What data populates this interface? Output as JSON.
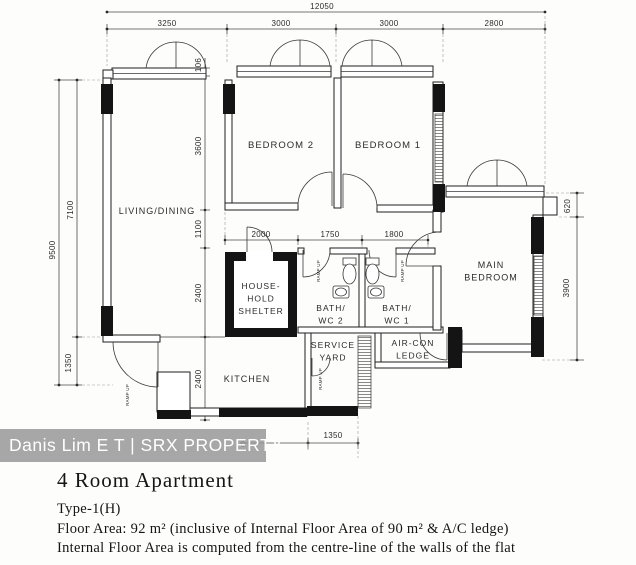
{
  "watermark": {
    "text": "Danis Lim E T | SRX PROPERTY",
    "bar_color": "rgba(152,152,152,0.85)",
    "text_color": "#ffffff"
  },
  "caption": {
    "title": "4 Room Apartment",
    "type": "Type-1(H)",
    "floor_area": "Floor Area: 92 m² (inclusive of Internal Floor Area of 90 m² & A/C ledge)",
    "note": "Internal Floor Area is computed from the centre-line of the walls of the flat"
  },
  "colors": {
    "plan_line": "#1f1f1f",
    "dimension_text": "#333333",
    "background": "#fdfdfb"
  },
  "rooms": [
    {
      "name": "living-dining",
      "lines": [
        "LIVING/DINING"
      ],
      "x": 157,
      "y": 214,
      "fs": 9
    },
    {
      "name": "bedroom-2",
      "lines": [
        "BEDROOM 2"
      ],
      "x": 281,
      "y": 148,
      "fs": 9.5
    },
    {
      "name": "bedroom-1",
      "lines": [
        "BEDROOM 1"
      ],
      "x": 388,
      "y": 148,
      "fs": 9.5
    },
    {
      "name": "main-bedroom",
      "lines": [
        "MAIN",
        "BEDROOM"
      ],
      "x": 491,
      "y": 268,
      "fs": 9
    },
    {
      "name": "household-shelter",
      "lines": [
        "HOUSE-",
        "HOLD",
        "SHELTER"
      ],
      "x": 261,
      "y": 289,
      "fs": 8.5
    },
    {
      "name": "bath-wc-2",
      "lines": [
        "BATH/",
        "WC 2"
      ],
      "x": 331,
      "y": 311,
      "fs": 8.5
    },
    {
      "name": "bath-wc-1",
      "lines": [
        "BATH/",
        "WC 1"
      ],
      "x": 397,
      "y": 311,
      "fs": 8.5
    },
    {
      "name": "service-yard",
      "lines": [
        "SERVICE",
        "YARD"
      ],
      "x": 333,
      "y": 348,
      "fs": 8.5
    },
    {
      "name": "kitchen",
      "lines": [
        "KITCHEN"
      ],
      "x": 247,
      "y": 382,
      "fs": 9
    },
    {
      "name": "air-con-ledge",
      "lines": [
        "AIR-CON",
        "LEDGE"
      ],
      "x": 413,
      "y": 346,
      "fs": 8.5
    }
  ],
  "dimensions": [
    {
      "t": "12050",
      "x": 322,
      "y": 9
    },
    {
      "t": "3250",
      "x": 167,
      "y": 26
    },
    {
      "t": "3000",
      "x": 281,
      "y": 26
    },
    {
      "t": "3000",
      "x": 389,
      "y": 26
    },
    {
      "t": "2800",
      "x": 494,
      "y": 26
    },
    {
      "t": "9500",
      "x": 55,
      "y": 250,
      "r": -90
    },
    {
      "t": "7100",
      "x": 73,
      "y": 210,
      "r": -90
    },
    {
      "t": "1350",
      "x": 71,
      "y": 363,
      "r": -90
    },
    {
      "t": "106",
      "x": 201,
      "y": 65,
      "r": -90
    },
    {
      "t": "3600",
      "x": 201,
      "y": 146,
      "r": -90
    },
    {
      "t": "1100",
      "x": 201,
      "y": 229,
      "r": -90
    },
    {
      "t": "2400",
      "x": 201,
      "y": 293,
      "r": -90
    },
    {
      "t": "2400",
      "x": 201,
      "y": 379,
      "r": -90
    },
    {
      "t": "2000",
      "x": 261,
      "y": 237
    },
    {
      "t": "1750",
      "x": 330,
      "y": 237
    },
    {
      "t": "1800",
      "x": 394,
      "y": 237
    },
    {
      "t": "620",
      "x": 570,
      "y": 206,
      "r": -90
    },
    {
      "t": "3900",
      "x": 569,
      "y": 288,
      "r": -90
    },
    {
      "t": "1350",
      "x": 333,
      "y": 438
    },
    {
      "t": "0",
      "x": 243,
      "y": 447
    }
  ],
  "ramp_labels": [
    {
      "t": "RAMP UP",
      "x": 320,
      "y": 271,
      "r": -90
    },
    {
      "t": "RAMP UP",
      "x": 404,
      "y": 271,
      "r": -90
    },
    {
      "t": "RAMP UP",
      "x": 129,
      "y": 395,
      "r": -90
    },
    {
      "t": "RAMP UP",
      "x": 322,
      "y": 379,
      "r": -90
    }
  ]
}
